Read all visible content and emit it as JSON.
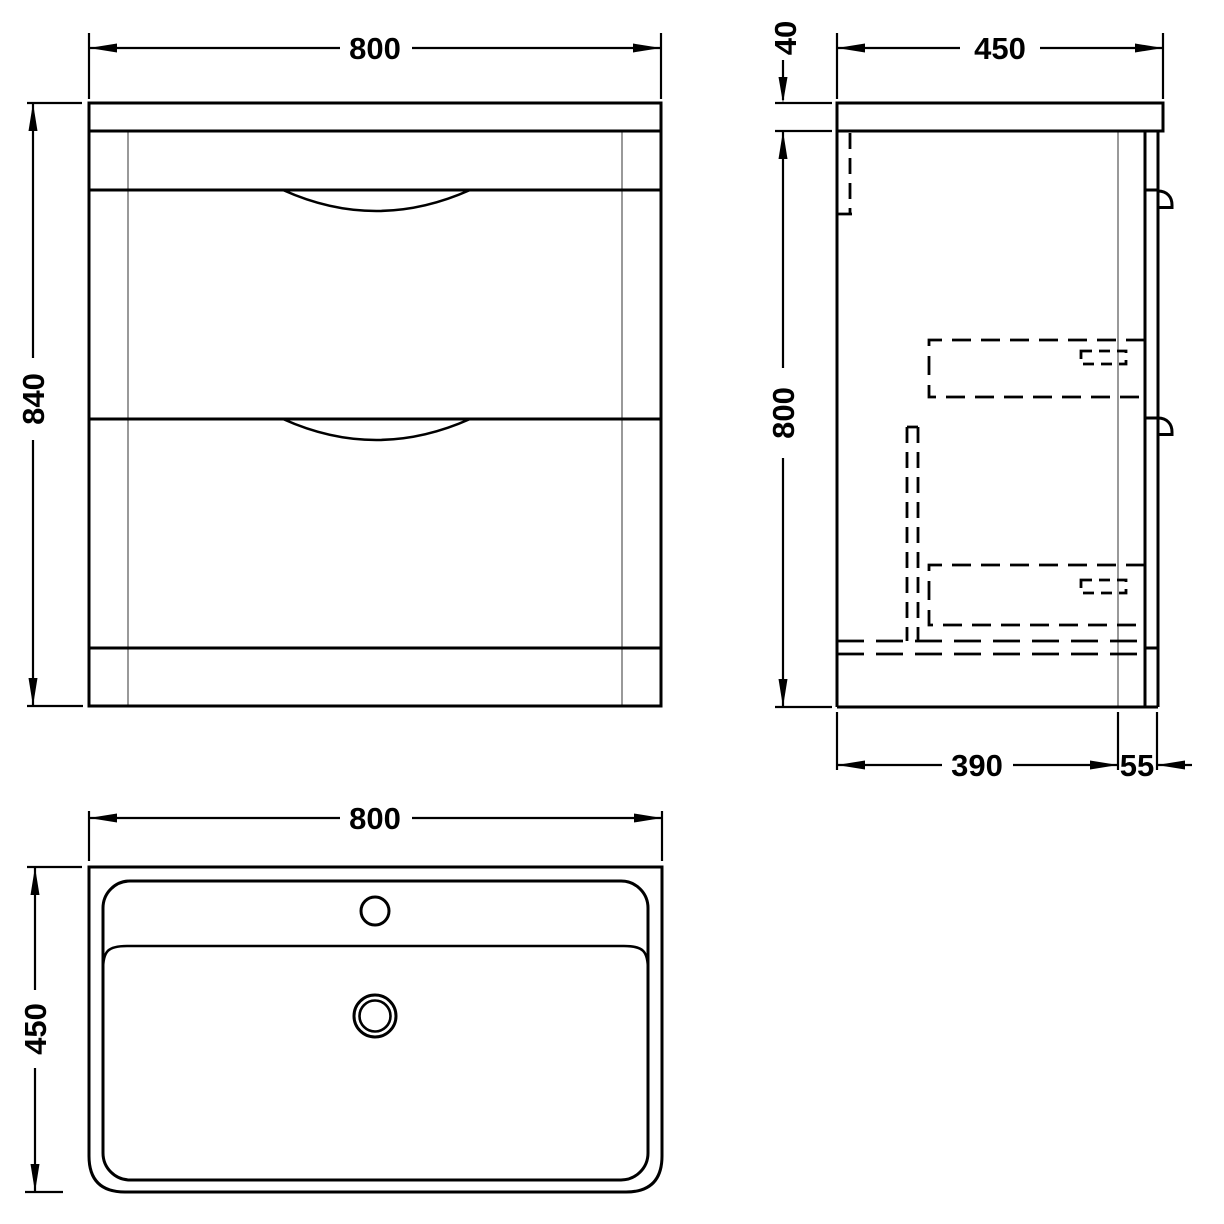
{
  "colors": {
    "line": "#000000",
    "projection": "#999999",
    "background": "#ffffff"
  },
  "views": {
    "front": {
      "width": "800",
      "height": "840"
    },
    "side": {
      "top_thickness": "40",
      "depth": "450",
      "height": "800",
      "base_depth": "390",
      "front_offset": "55"
    },
    "plan": {
      "width": "800",
      "depth": "450"
    }
  }
}
